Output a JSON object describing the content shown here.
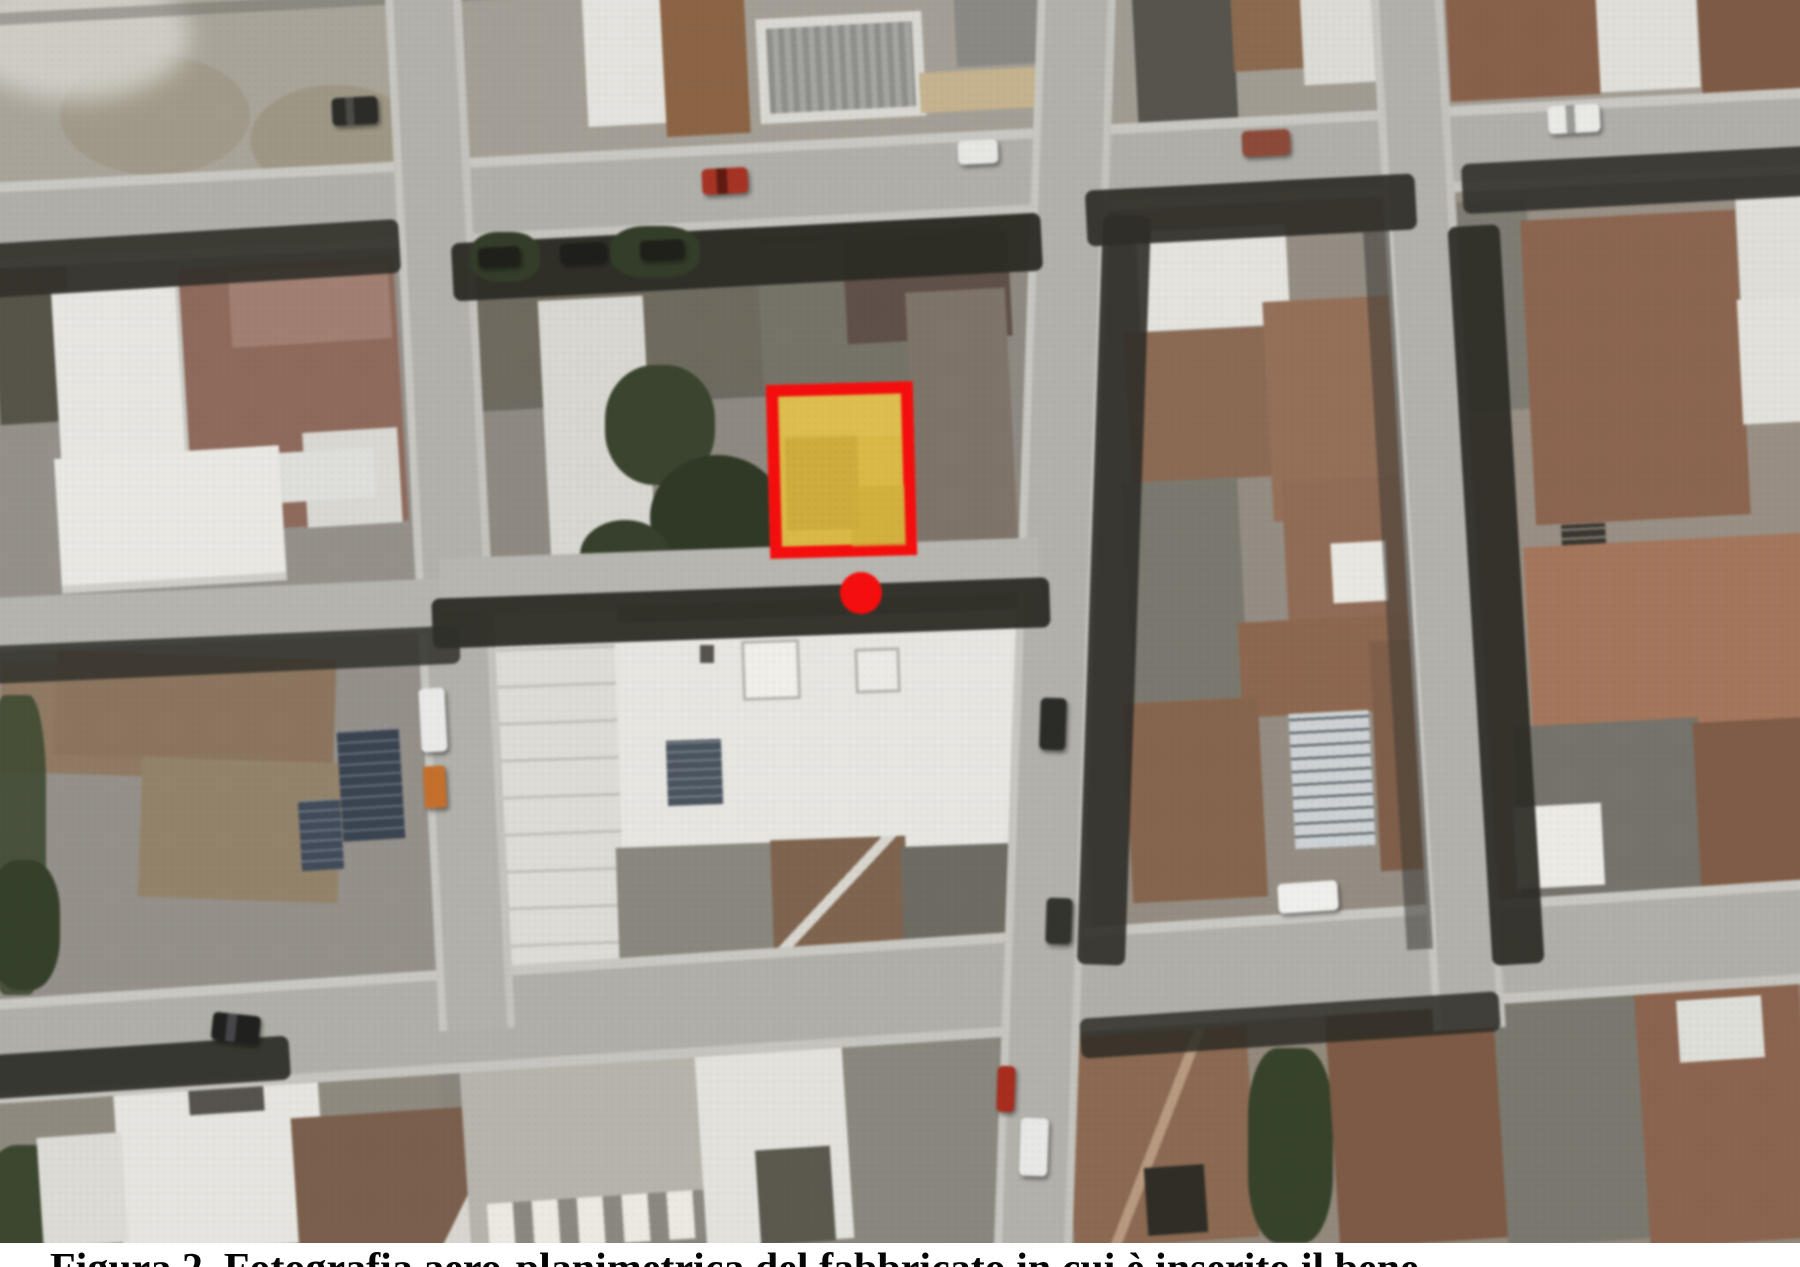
{
  "figure": {
    "kind": "aerial orthophoto of an urban block with an annotated building parcel",
    "caption": "Figura 2. Fotografia aero-planimetrica del fabbricato in cui è inserito il bene",
    "caption_visibility": "caption clipped at bottom edge of image, only top half of letters visible"
  },
  "annotations": {
    "parcel_highlight": {
      "shape": "rectangle",
      "border_color": "#ee1010",
      "fill_color": "#d9b94b",
      "fill_opacity": 0.6,
      "x": 768,
      "y": 383,
      "width": 147,
      "height": 174,
      "rotation_deg": -1.5
    },
    "location_dot": {
      "shape": "circle",
      "color": "#ee1010",
      "cx": 861,
      "cy": 593,
      "radius": 21
    }
  },
  "palette": {
    "street": "#b0afa9",
    "sidewalk": "#c9c8c2",
    "shadow": "#2c2c25",
    "roof_brown": "#8a6550",
    "roof_white": "#e7e6e1",
    "roof_dark_gray": "#6d6a62",
    "vegetation": "#3a442f",
    "dirt_lot": "#a9a49a",
    "highlight_red": "#ee1010",
    "highlight_yellow": "#d9b94b"
  }
}
